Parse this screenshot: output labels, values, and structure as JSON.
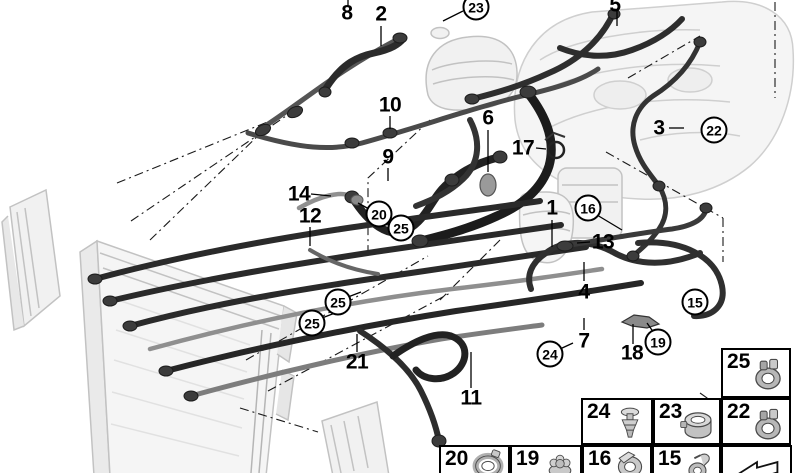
{
  "diagram_type": "parts-diagram-cooling-system-hoses",
  "colors": {
    "hose_dark": "#262626",
    "pipe_light": "#8f8f8f",
    "faded_part": "#bdbdbd",
    "line": "#111111",
    "background": "#ffffff"
  },
  "callouts": [
    {
      "label": "8",
      "x": 347,
      "y": 13,
      "circled": false
    },
    {
      "label": "2",
      "x": 381,
      "y": 14,
      "circled": false
    },
    {
      "label": "5",
      "x": 615,
      "y": 5,
      "circled": false
    },
    {
      "label": "23",
      "x": 476,
      "y": 7,
      "circled": true
    },
    {
      "label": "10",
      "x": 390,
      "y": 105,
      "circled": false
    },
    {
      "label": "6",
      "x": 488,
      "y": 118,
      "circled": false
    },
    {
      "label": "3",
      "x": 659,
      "y": 128,
      "circled": false
    },
    {
      "label": "22",
      "x": 714,
      "y": 130,
      "circled": true
    },
    {
      "label": "17",
      "x": 523,
      "y": 148,
      "circled": false
    },
    {
      "label": "9",
      "x": 388,
      "y": 157,
      "circled": false
    },
    {
      "label": "14",
      "x": 299,
      "y": 194,
      "circled": false
    },
    {
      "label": "1",
      "x": 552,
      "y": 208,
      "circled": false
    },
    {
      "label": "16",
      "x": 588,
      "y": 208,
      "circled": true
    },
    {
      "label": "20",
      "x": 379,
      "y": 214,
      "circled": true
    },
    {
      "label": "12",
      "x": 310,
      "y": 216,
      "circled": false
    },
    {
      "label": "25",
      "x": 401,
      "y": 228,
      "circled": true
    },
    {
      "label": "13",
      "x": 603,
      "y": 242,
      "circled": false
    },
    {
      "label": "4",
      "x": 584,
      "y": 292,
      "circled": false
    },
    {
      "label": "15",
      "x": 695,
      "y": 302,
      "circled": true
    },
    {
      "label": "25",
      "x": 338,
      "y": 302,
      "circled": true
    },
    {
      "label": "25",
      "x": 312,
      "y": 323,
      "circled": true
    },
    {
      "label": "7",
      "x": 584,
      "y": 341,
      "circled": false
    },
    {
      "label": "19",
      "x": 658,
      "y": 342,
      "circled": true
    },
    {
      "label": "18",
      "x": 632,
      "y": 353,
      "circled": false
    },
    {
      "label": "24",
      "x": 550,
      "y": 354,
      "circled": true
    },
    {
      "label": "21",
      "x": 357,
      "y": 362,
      "circled": false
    },
    {
      "label": "11",
      "x": 471,
      "y": 398,
      "circled": false
    }
  ],
  "legend": {
    "cells": [
      {
        "label": "25",
        "icon": "hose-clamp-icon",
        "x": 721,
        "y": 348,
        "w": 70,
        "h": 50,
        "size": "tall"
      },
      {
        "label": "24",
        "icon": "expansion-rivet-icon",
        "x": 581,
        "y": 398,
        "w": 72,
        "h": 47,
        "size": "tall"
      },
      {
        "label": "23",
        "icon": "profile-clamp-icon",
        "x": 653,
        "y": 398,
        "w": 68,
        "h": 47,
        "size": "tall"
      },
      {
        "label": "22",
        "icon": "hose-clamp-icon",
        "x": 721,
        "y": 398,
        "w": 70,
        "h": 47,
        "size": "tall"
      },
      {
        "label": "20",
        "icon": "hose-clamp-large-icon",
        "x": 439,
        "y": 445,
        "w": 71,
        "h": 45,
        "size": "short"
      },
      {
        "label": "19",
        "icon": "plastic-nut-icon",
        "x": 510,
        "y": 445,
        "w": 72,
        "h": 45,
        "size": "short"
      },
      {
        "label": "16",
        "icon": "holder-clamp-icon",
        "x": 582,
        "y": 445,
        "w": 70,
        "h": 45,
        "size": "short"
      },
      {
        "label": "15",
        "icon": "spring-clamp-icon",
        "x": 652,
        "y": 445,
        "w": 69,
        "h": 45,
        "size": "short"
      },
      {
        "label": "",
        "icon": "direction-arrow-icon",
        "x": 721,
        "y": 445,
        "w": 71,
        "h": 45,
        "size": "arrow"
      }
    ]
  }
}
